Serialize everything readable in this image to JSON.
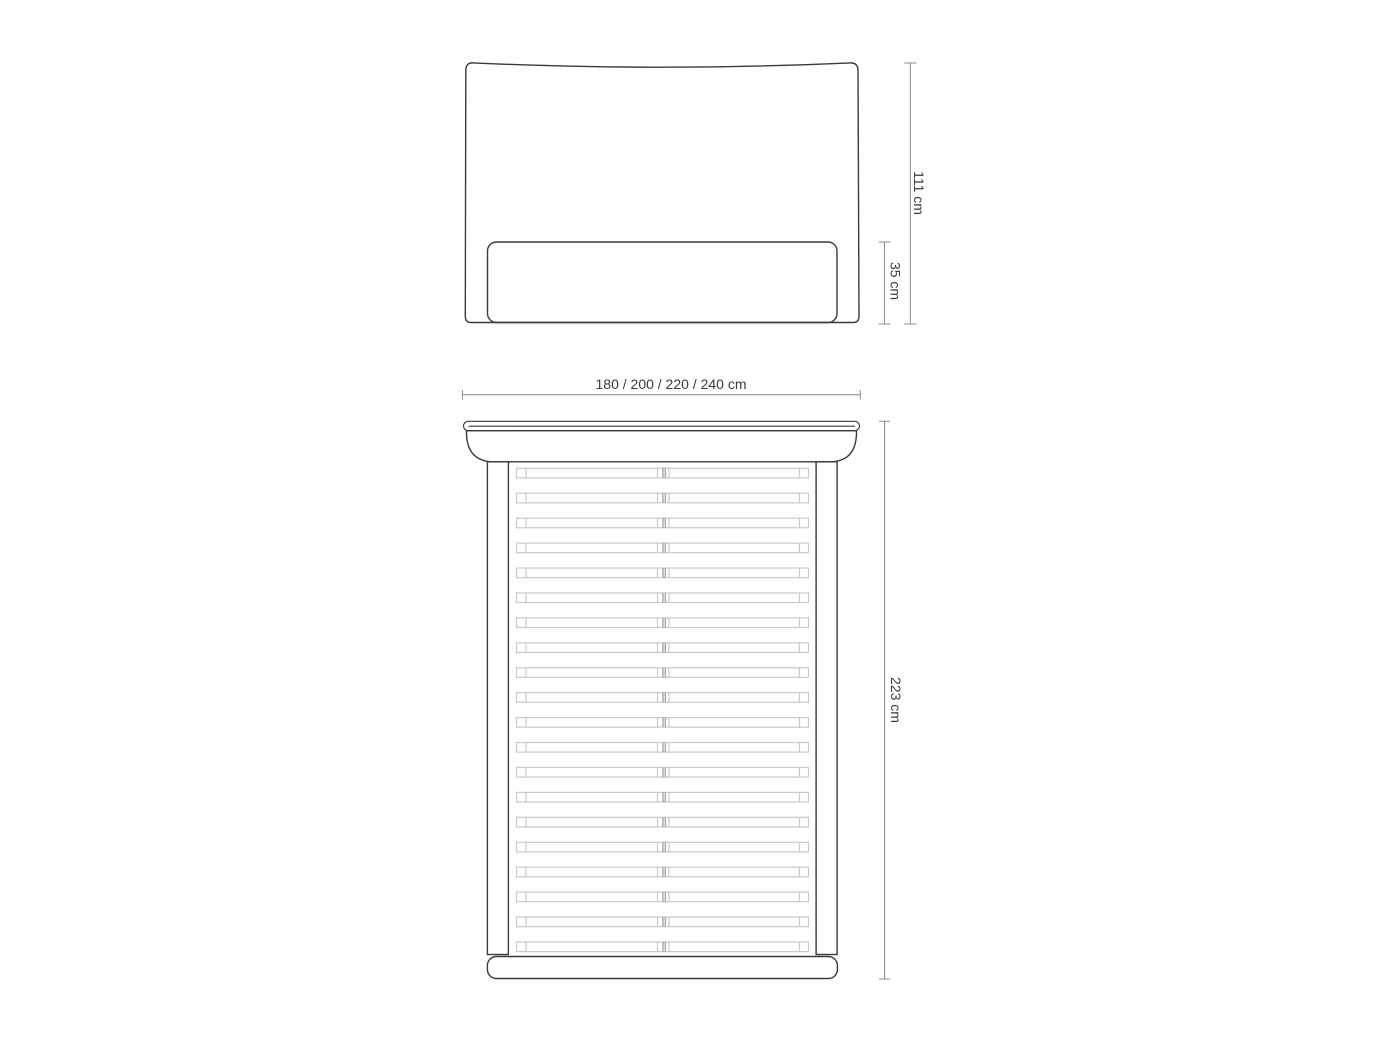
{
  "front_view": {
    "height_label": "111 cm",
    "base_height_label": "35 cm"
  },
  "top_view": {
    "width_label": "180 / 200 / 220 / 240 cm",
    "length_label": "223 cm",
    "slat_count": 20,
    "slat_columns": 2
  },
  "colors": {
    "outline": "#3a3a3a",
    "dimension": "#8c8c8c",
    "slat": "#c9c9c9",
    "slat_center": "#999999",
    "text": "#3b3b3b",
    "background": "#ffffff"
  }
}
